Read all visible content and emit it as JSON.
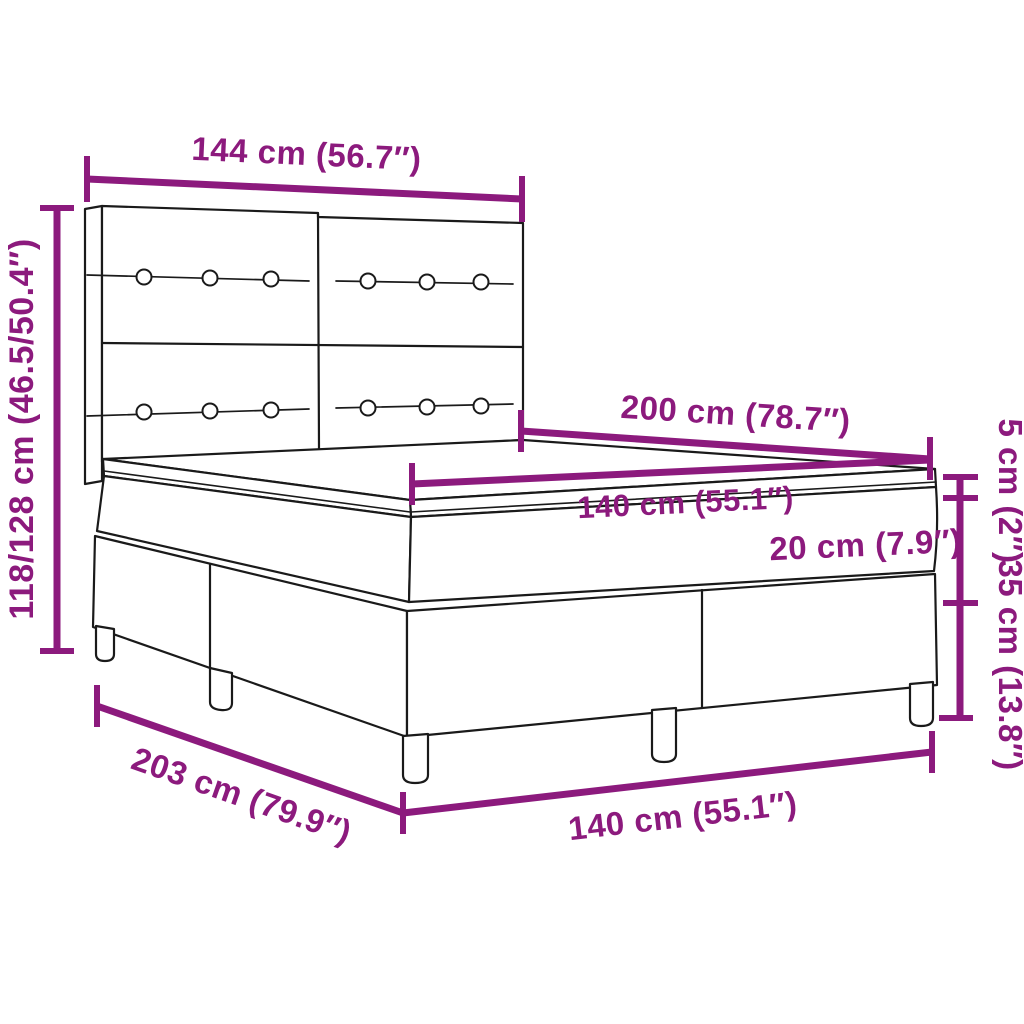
{
  "diagram": {
    "kind": "product-dimension-diagram",
    "subject": "box-spring-bed-with-headboard-topper-and-legs",
    "background": "#ffffff",
    "accent_color": "#8C1A7D",
    "line_color": "#1a1a1a",
    "dimensions": {
      "headboard_width": "144 cm (56.7″)",
      "headboard_height_range": "118/128 cm (46.5/50.4″)",
      "bed_length": "200 cm (78.7″)",
      "mattress_width_top": "140 cm (55.1″)",
      "topper_thickness": "5 cm (2″)",
      "mattress_thickness": "20 cm (7.9″)",
      "base_height": "35 cm (13.8″)",
      "total_length_floor": "203 cm (79.9″)",
      "bed_width_floor": "140 cm (55.1″)"
    }
  }
}
